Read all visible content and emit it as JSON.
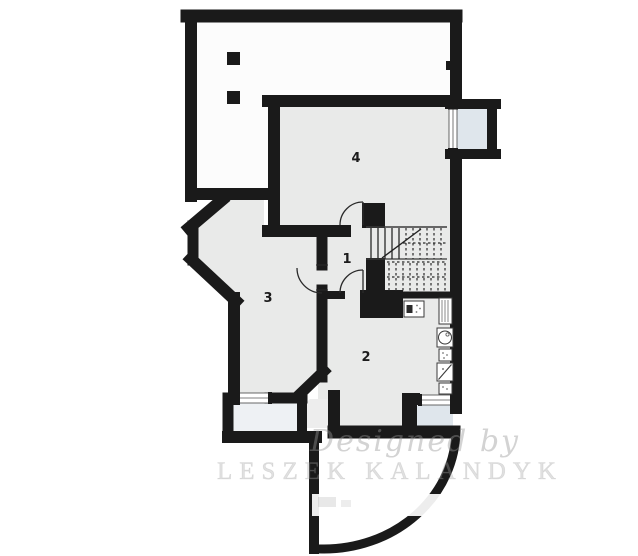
{
  "plan": {
    "type": "architectural-floor-plan",
    "rooms": [
      {
        "number": "1"
      },
      {
        "number": "2"
      },
      {
        "number": "3"
      },
      {
        "number": "4"
      }
    ],
    "watermark": {
      "line1": "Designed by",
      "line2": "LESZEK KALANDYK"
    },
    "fixtures": [
      {
        "name": "furnace"
      },
      {
        "name": "radiator"
      },
      {
        "name": "washing-machine"
      },
      {
        "name": "cabinet"
      },
      {
        "name": "shower-tray"
      },
      {
        "name": "cabinet"
      }
    ],
    "colors": {
      "wall": "#1a1a1a",
      "room_fill": "#e9eae9",
      "outdoor_fill": "#fcfcfc",
      "window_well_fill": "#dfe6ec",
      "watermark_text": "#a5a5a5"
    }
  }
}
